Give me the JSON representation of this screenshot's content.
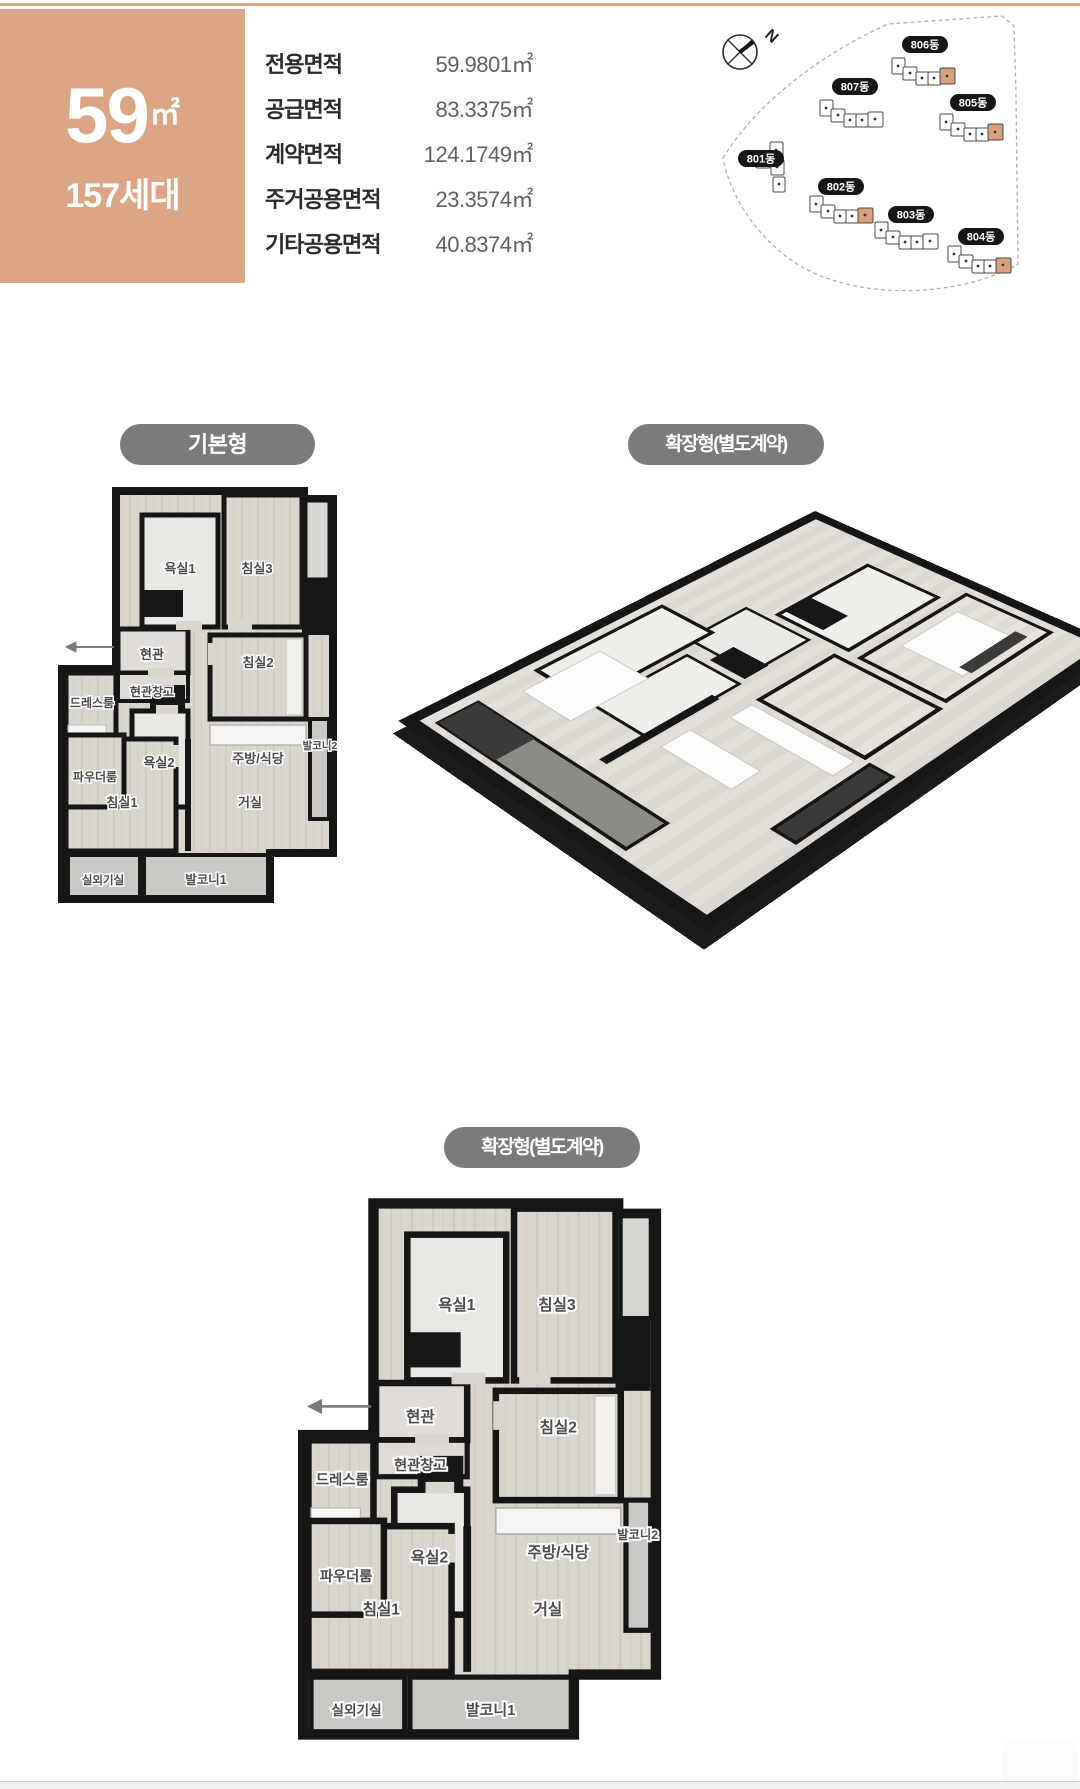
{
  "header": {
    "unit_size": "59",
    "unit_size_unit": "㎡",
    "households": "157세대",
    "area_table": [
      {
        "label": "전용면적",
        "value": "59.9801㎡"
      },
      {
        "label": "공급면적",
        "value": "83.3375㎡"
      },
      {
        "label": "계약면적",
        "value": "124.1749㎡"
      },
      {
        "label": "주거공용면적",
        "value": "23.3574㎡"
      },
      {
        "label": "기타공용면적",
        "value": "40.8374㎡"
      }
    ]
  },
  "site_map": {
    "north_label": "N",
    "buildings": [
      {
        "label": "801동",
        "highlighted": false
      },
      {
        "label": "802동",
        "highlighted": true
      },
      {
        "label": "803동",
        "highlighted": false
      },
      {
        "label": "804동",
        "highlighted": true
      },
      {
        "label": "805동",
        "highlighted": true
      },
      {
        "label": "806동",
        "highlighted": true
      },
      {
        "label": "807동",
        "highlighted": false
      }
    ]
  },
  "sections": {
    "basic_badge": "기본형",
    "expanded_badge": "확장형(별도계약)"
  },
  "plans": {
    "rooms": {
      "bath1": "욕실1",
      "bed3": "침실3",
      "entrance": "현관",
      "entrance_storage": "현관창고",
      "dress_room": "드레스룸",
      "powder_room": "파우더룸",
      "bath2": "욕실2",
      "bed2": "침실2",
      "kitchen": "주방/식당",
      "balcony2": "발코니2",
      "bed1": "침실1",
      "living": "거실",
      "ac_room": "실외기실",
      "balcony1": "발코니1"
    }
  },
  "colors": {
    "accent_tan": "#dca586",
    "badge_gray": "#7c7b7a",
    "wall_black": "#161616",
    "highlight_unit": "#d8a07e"
  }
}
